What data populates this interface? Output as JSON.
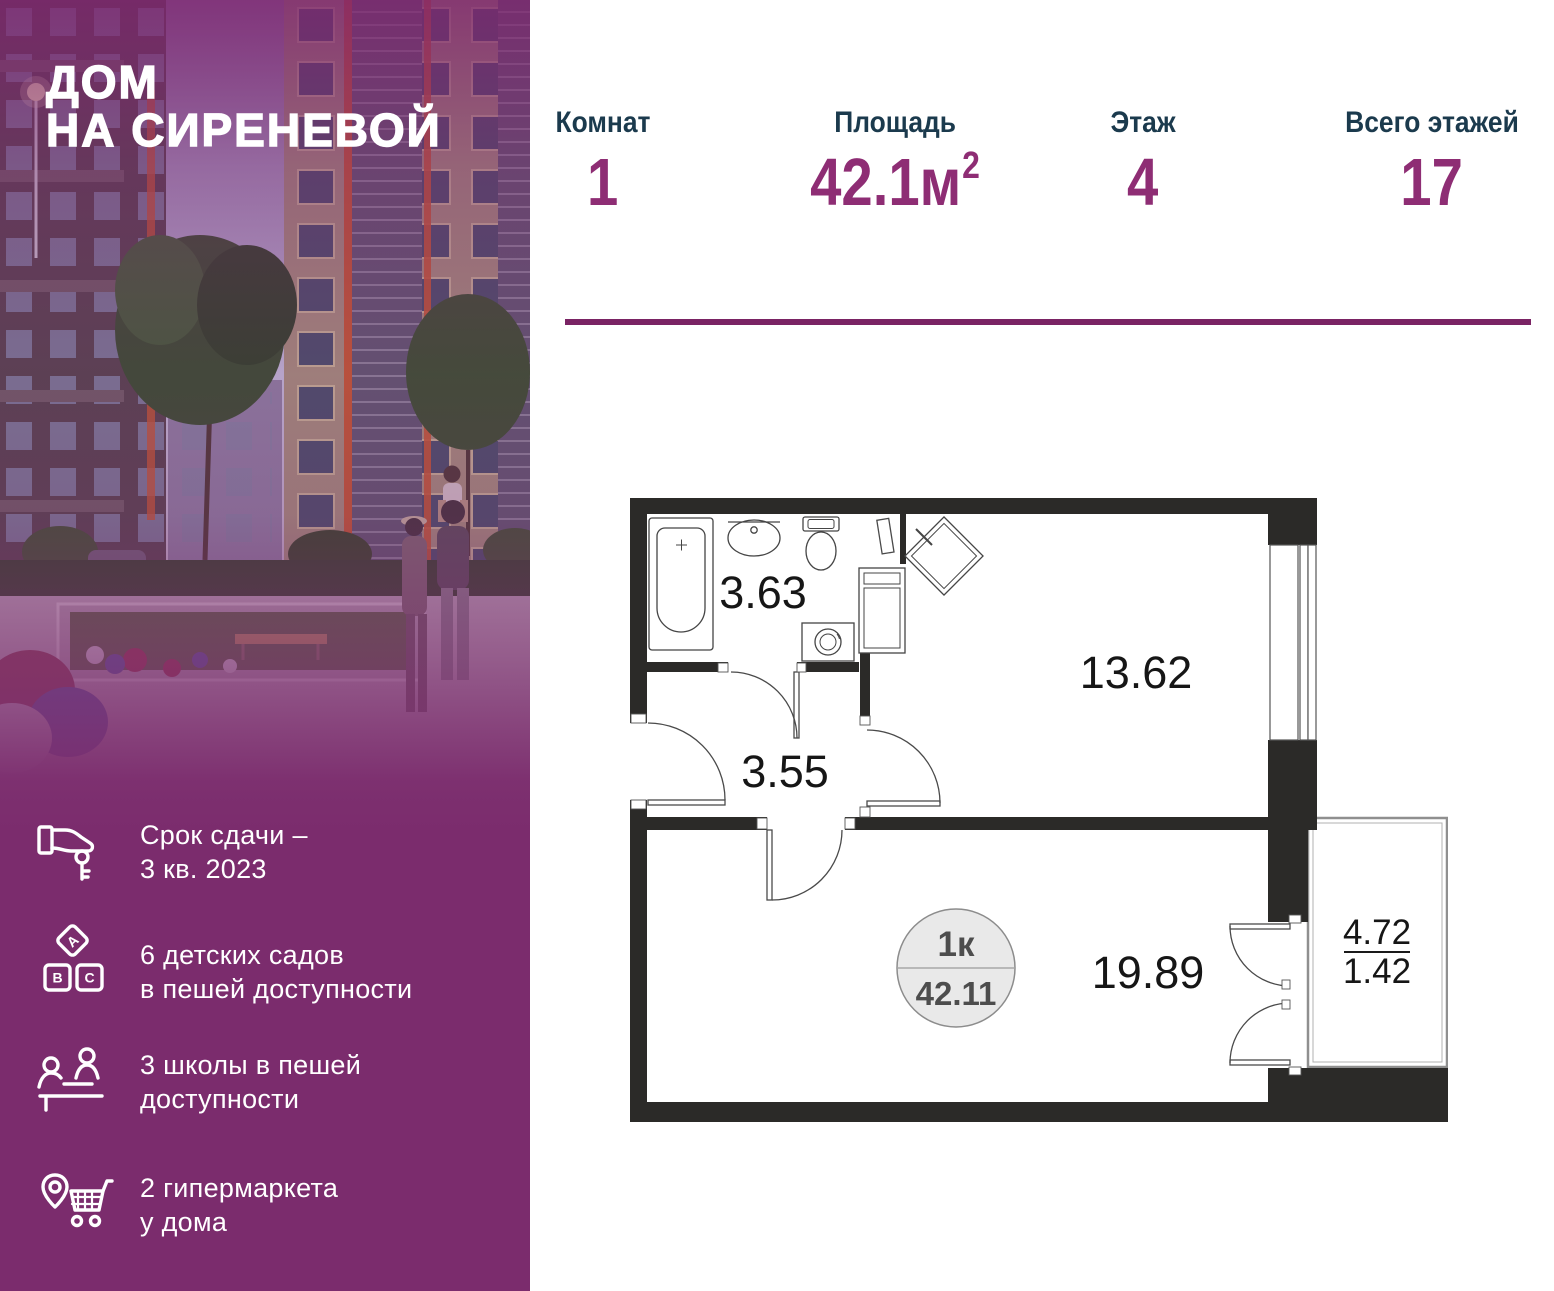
{
  "sidebar": {
    "logo_line1": "ДОМ",
    "logo_line2": "НА СИРЕНЕВОЙ",
    "abc_letters": [
      "А",
      "В",
      "С"
    ],
    "features": [
      {
        "icon": "key-handover-icon",
        "lines": [
          "Срок сдачи –",
          "3 кв. 2023"
        ]
      },
      {
        "icon": "abc-blocks-icon",
        "lines": [
          "6 детских садов",
          "в пешей доступности"
        ]
      },
      {
        "icon": "school-desk-icon",
        "lines": [
          "3 школы в пешей",
          "доступности"
        ]
      },
      {
        "icon": "store-location-icon",
        "lines": [
          "2 гипермаркета",
          "у дома"
        ]
      }
    ]
  },
  "stats": [
    {
      "label": "Комнат",
      "value": "1"
    },
    {
      "label": "Площадь",
      "value": "42.1м",
      "sup": "2"
    },
    {
      "label": "Этаж",
      "value": "4"
    },
    {
      "label": "Всего этажей",
      "value": "17"
    }
  ],
  "floorplan": {
    "unit_badge": {
      "rooms_label": "1к",
      "total_area": "42.11"
    },
    "rooms": [
      {
        "name": "bathroom",
        "area": "3.63"
      },
      {
        "name": "hallway",
        "area": "3.55"
      },
      {
        "name": "kitchen-living",
        "area": "13.62"
      },
      {
        "name": "bedroom",
        "area": "19.89"
      }
    ],
    "balcony": {
      "area_full": "4.72",
      "area_reduced": "1.42"
    }
  },
  "colors": {
    "sidebar_purple": "#7B2C6D",
    "stat_label": "#1B3A4D",
    "stat_value": "#8E2D74",
    "divider": "#7A2364",
    "wall": "#2B2A28"
  }
}
